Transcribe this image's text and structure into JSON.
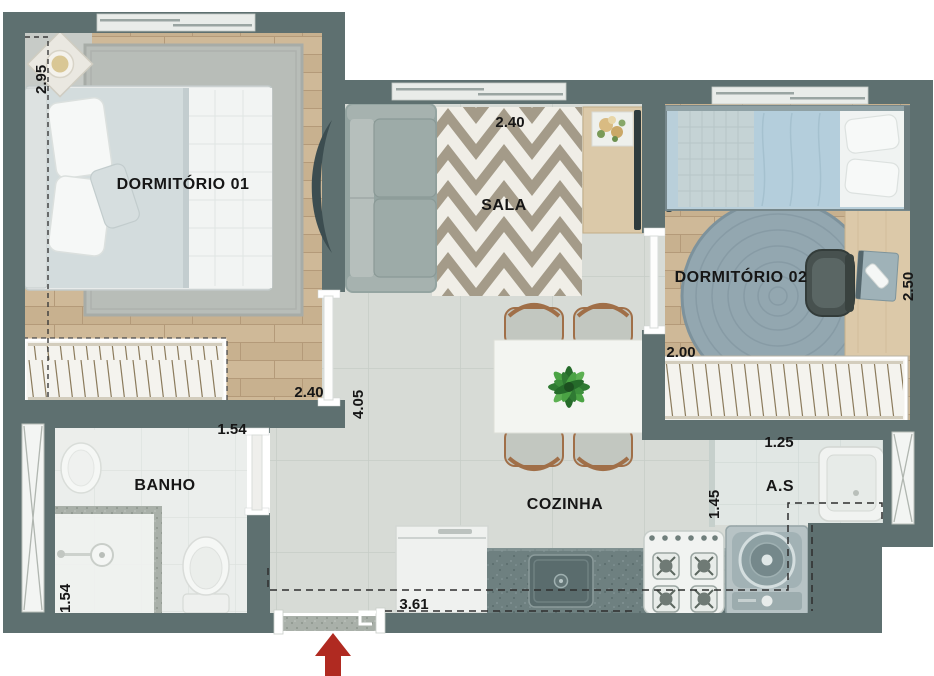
{
  "plan": {
    "title": "apartment-floor-plan",
    "rooms": [
      {
        "id": "dormitorio-01",
        "label": "DORMITÓRIO 01"
      },
      {
        "id": "sala",
        "label": "SALA"
      },
      {
        "id": "dormitorio-02",
        "label": "DORMITÓRIO 02"
      },
      {
        "id": "banho",
        "label": "BANHO"
      },
      {
        "id": "cozinha",
        "label": "COZINHA"
      },
      {
        "id": "area-servico",
        "label": "A.S"
      }
    ],
    "dimensions": [
      {
        "id": "dorm1-left-width",
        "value": "2.95",
        "orientation": "vertical"
      },
      {
        "id": "sala-width",
        "value": "2.40",
        "orientation": "horizontal"
      },
      {
        "id": "dorm2-depth",
        "value": "2.50",
        "orientation": "vertical"
      },
      {
        "id": "dorm2-width",
        "value": "2.00",
        "orientation": "horizontal"
      },
      {
        "id": "dorm1-bottom-width",
        "value": "2.40",
        "orientation": "horizontal"
      },
      {
        "id": "hall-depth",
        "value": "4.05",
        "orientation": "vertical"
      },
      {
        "id": "banho-door-width",
        "value": "1.54",
        "orientation": "horizontal"
      },
      {
        "id": "banho-width",
        "value": "1.54",
        "orientation": "vertical"
      },
      {
        "id": "as-width",
        "value": "1.25",
        "orientation": "horizontal"
      },
      {
        "id": "as-depth",
        "value": "1.45",
        "orientation": "vertical"
      },
      {
        "id": "kitchen-width",
        "value": "3.61",
        "orientation": "horizontal"
      }
    ],
    "colors": {
      "wall": "#5e7070",
      "wood_floor": "#cfb998",
      "tile_floor": "#d7dbd6",
      "bath_tile": "#ebeeec",
      "counter": "#6e8080",
      "entry_arrow": "#b02a21",
      "chevron_rug": "#a49b89",
      "round_rug": "#93a7b0"
    }
  }
}
